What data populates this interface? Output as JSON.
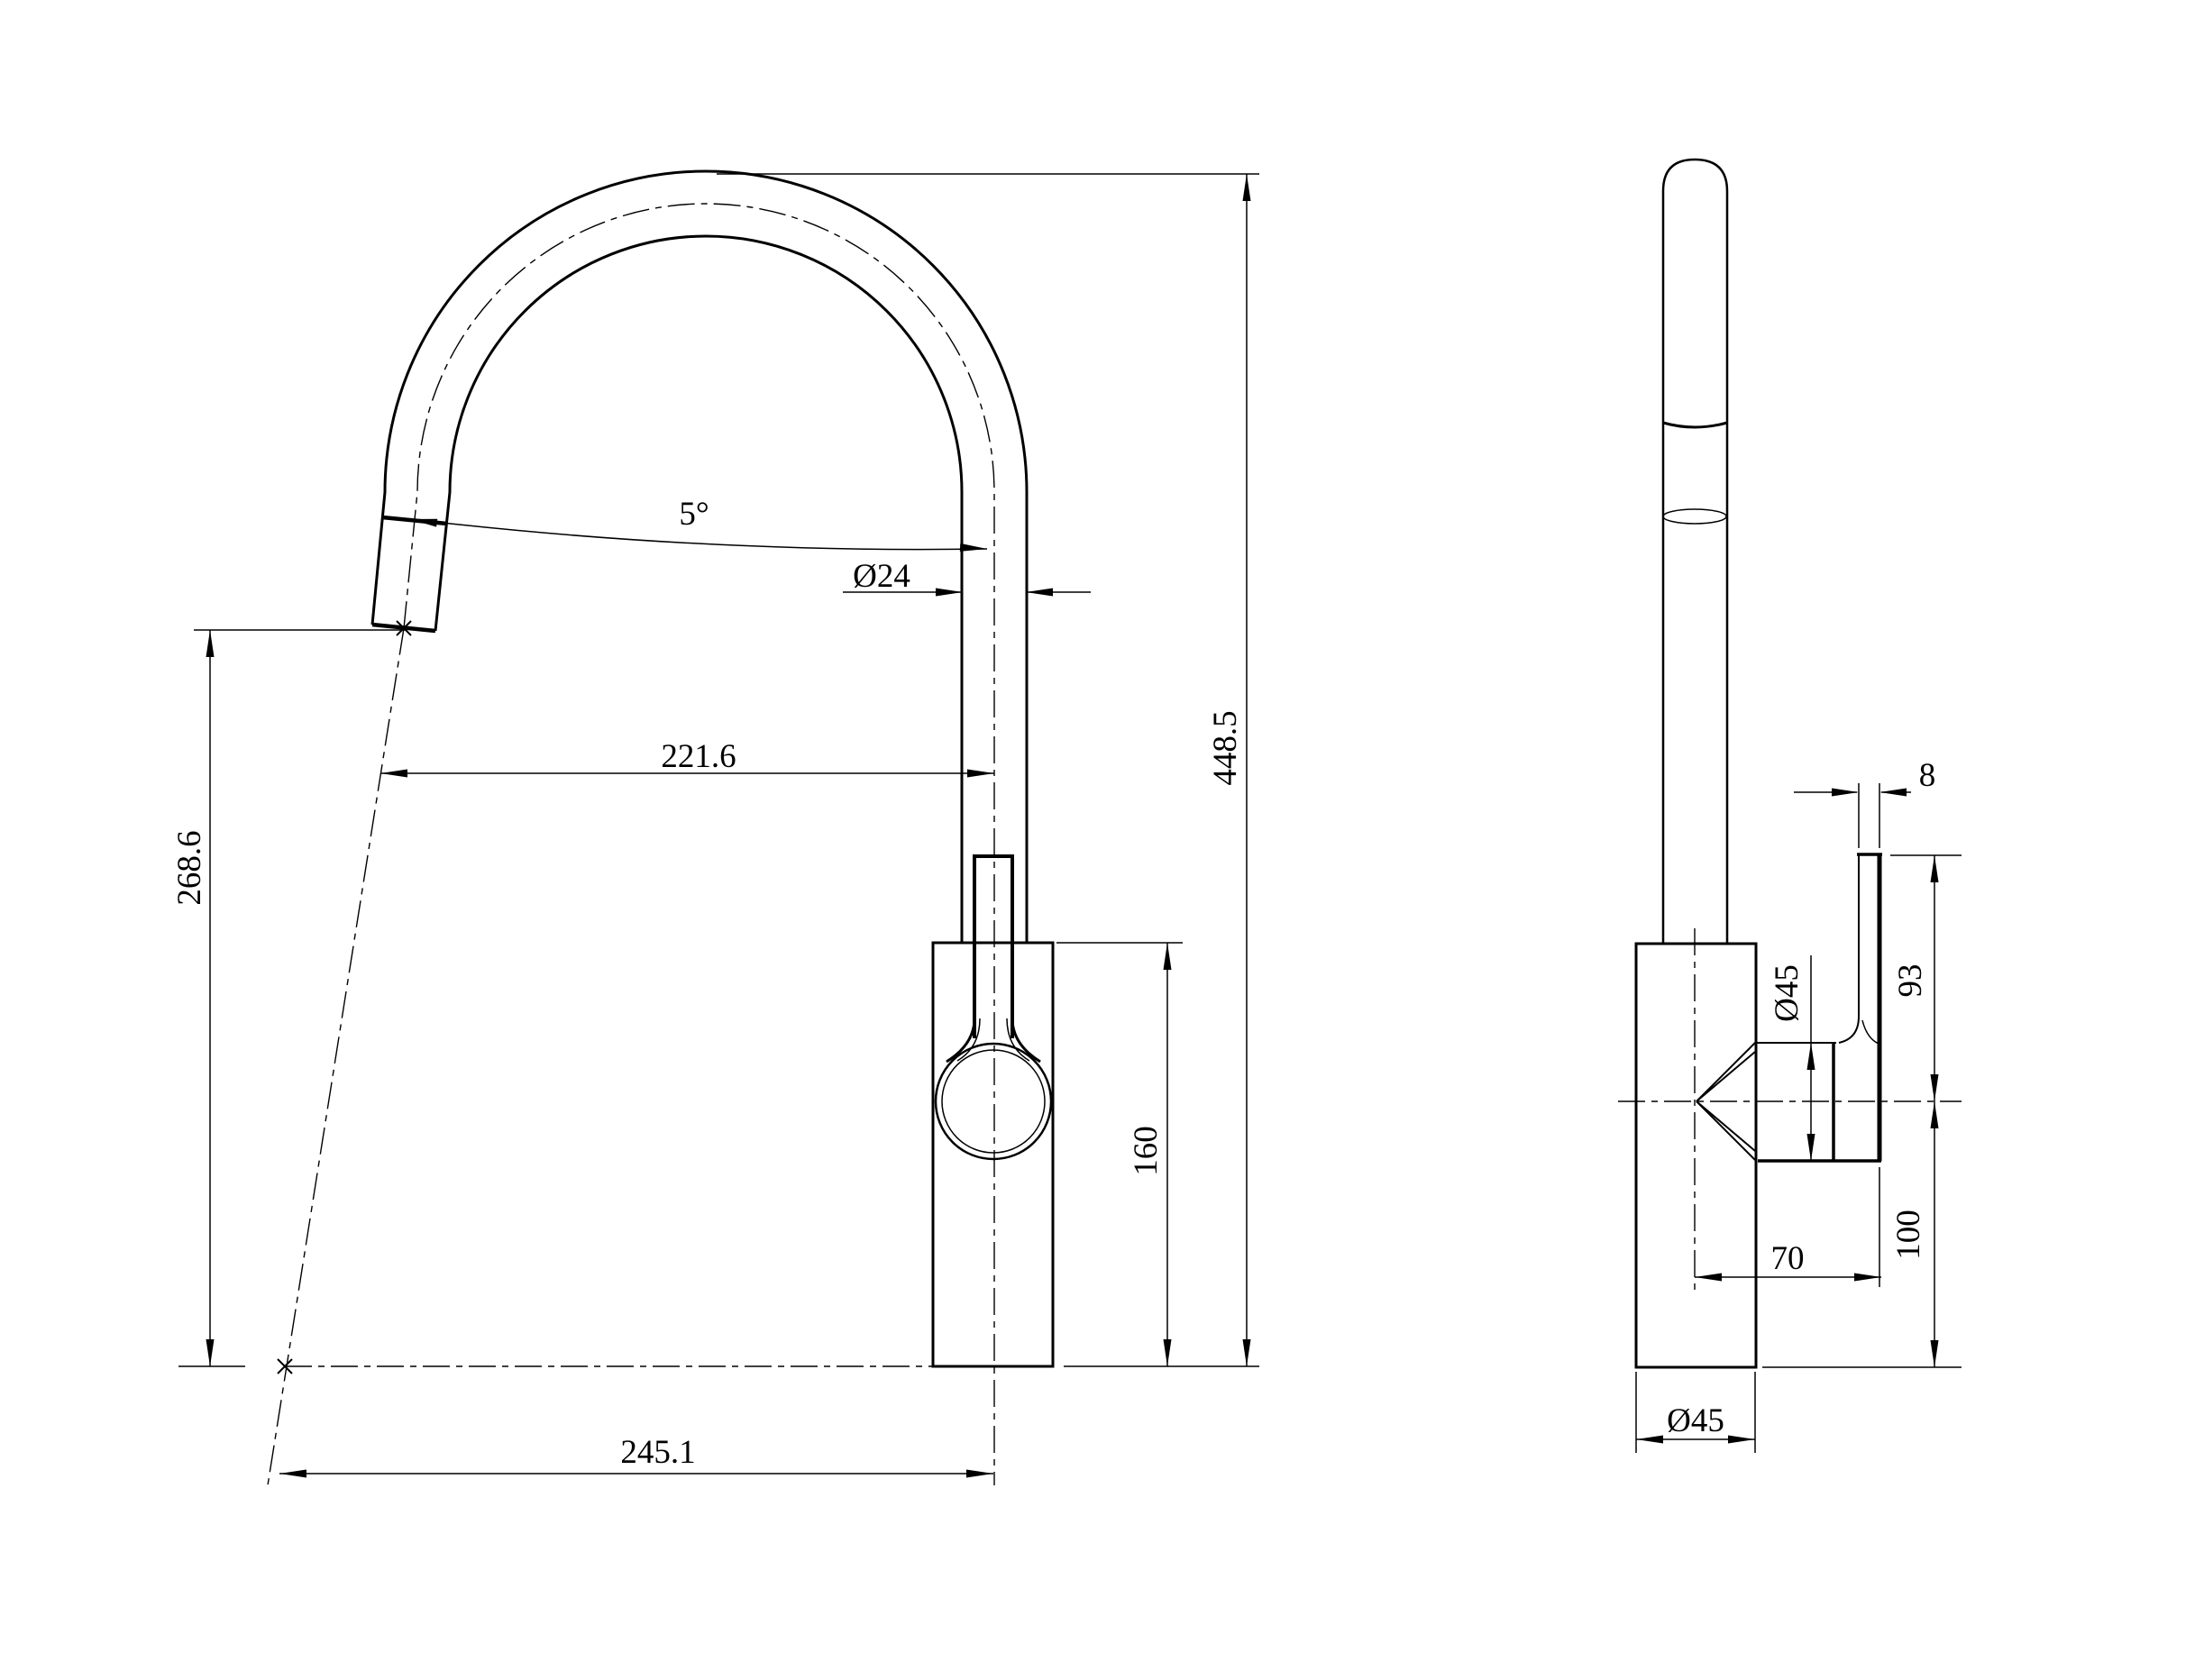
{
  "page": {
    "background": "#ffffff",
    "line_color": "#000000",
    "type": "faucet technical drawing, front and side orthographic views"
  },
  "front_view": {
    "dimensions": {
      "spout_angle": "5°",
      "spout_diameter": "Ø24",
      "spout_reach": "221.6",
      "overall_height": "448.5",
      "spout_clearance": "268.6",
      "body_height": "160",
      "tip_to_axis": "245.1"
    }
  },
  "side_view": {
    "dimensions": {
      "lever_thickness": "8",
      "lever_height": "93",
      "cartridge_diameter": "Ø45",
      "handle_reach": "70",
      "below_center_height": "100",
      "base_diameter": "Ø45"
    }
  }
}
